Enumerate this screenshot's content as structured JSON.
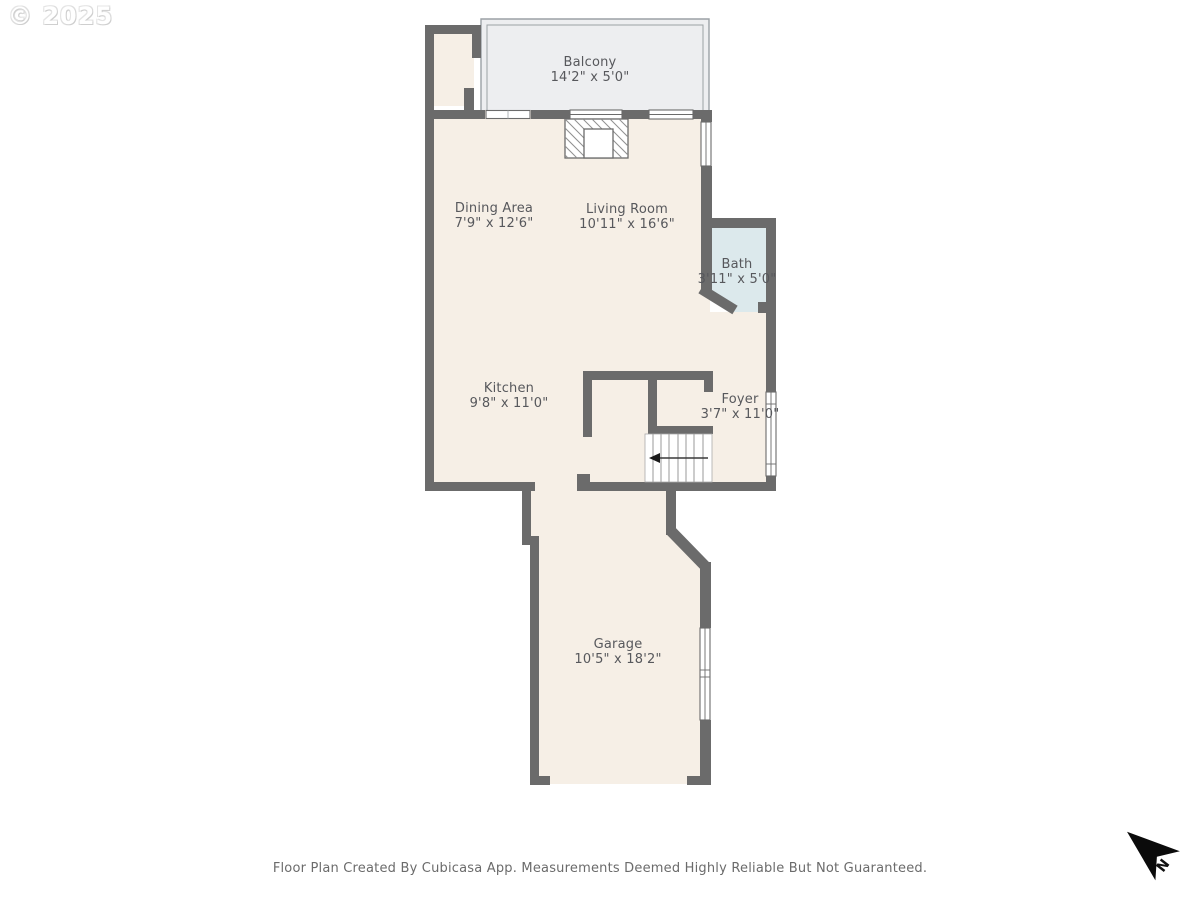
{
  "watermark": {
    "text": "© 2025"
  },
  "floor_plan": {
    "rooms": [
      {
        "name": "Balcony",
        "dimensions": "14'2\" x 5'0\""
      },
      {
        "name": "Dining Area",
        "dimensions": "7'9\" x 12'6\""
      },
      {
        "name": "Living Room",
        "dimensions": "10'11\" x 16'6\""
      },
      {
        "name": "Bath",
        "dimensions": "3'11\" x 5'0\""
      },
      {
        "name": "Kitchen",
        "dimensions": "9'8\" x 11'0\""
      },
      {
        "name": "Foyer",
        "dimensions": "3'7\" x 11'0\""
      },
      {
        "name": "Garage",
        "dimensions": "10'5\" x 18'2\""
      }
    ],
    "features": [
      "fireplace",
      "staircase-down-arrow",
      "garage-door-opening"
    ],
    "colors": {
      "wall": "#6b6b6b",
      "floor": "#f6efe6",
      "balcony": "#edeef0",
      "bath": "#dce9ec",
      "railing": "#9ba1a5",
      "label_text": "#57585c"
    }
  },
  "north_arrow": {
    "label": "N"
  },
  "footer": {
    "text": "Floor Plan Created By Cubicasa App. Measurements Deemed Highly Reliable But Not Guaranteed."
  }
}
